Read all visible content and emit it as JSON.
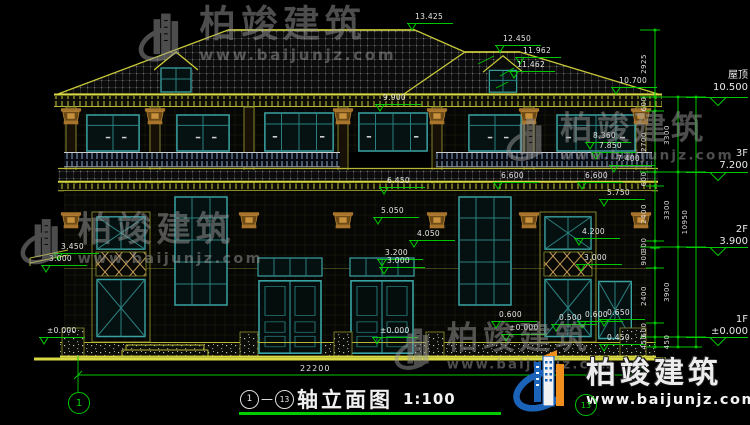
{
  "title_block": {
    "axis_start": "1",
    "axis_end": "13",
    "dash": "—",
    "name": "轴立面图",
    "scale": "1:100"
  },
  "axis_bubbles": {
    "left": "1",
    "right": "13"
  },
  "bottom_dimension": {
    "value": "22200"
  },
  "watermark": {
    "brand": "柏竣建筑",
    "url": "www.baijunjz.com",
    "gray_positions": [
      {
        "x": 138,
        "y": 6,
        "s": 1.02
      },
      {
        "x": 506,
        "y": 112,
        "s": 0.9
      },
      {
        "x": 20,
        "y": 212,
        "s": 0.96
      },
      {
        "x": 394,
        "y": 322,
        "s": 0.88
      }
    ]
  },
  "floor_labels": [
    {
      "name": "屋顶",
      "elev": "10.500",
      "top": 70,
      "sym": 95
    },
    {
      "name": "3F",
      "elev": "7.200",
      "top": 148,
      "sym": 170
    },
    {
      "name": "2F",
      "elev": "3.900",
      "top": 224,
      "sym": 245
    },
    {
      "name": "1F",
      "elev": "±0.000",
      "top": 314,
      "sym": 335
    }
  ],
  "dim_chains": [
    {
      "x": 655,
      "segs": [
        {
          "label": "2925",
          "y1": 30,
          "y2": 97
        },
        {
          "label": "600",
          "y1": 97,
          "y2": 111
        },
        {
          "label": "2700",
          "y1": 111,
          "y2": 172
        },
        {
          "label": "600",
          "y1": 172,
          "y2": 186
        },
        {
          "label": "2400",
          "y1": 186,
          "y2": 241
        },
        {
          "label": "300",
          "y1": 241,
          "y2": 248
        },
        {
          "label": "900",
          "y1": 248,
          "y2": 268
        },
        {
          "label": "2400",
          "y1": 268,
          "y2": 323
        },
        {
          "label": "600",
          "y1": 323,
          "y2": 337
        },
        {
          "label": "450",
          "y1": 337,
          "y2": 347
        }
      ]
    },
    {
      "x": 678,
      "segs": [
        {
          "label": "3300",
          "y1": 97,
          "y2": 172
        },
        {
          "label": "3300",
          "y1": 172,
          "y2": 247
        },
        {
          "label": "3900",
          "y1": 247,
          "y2": 337
        },
        {
          "label": "450",
          "y1": 337,
          "y2": 347
        }
      ]
    },
    {
      "x": 696,
      "segs": [
        {
          "label": "10950",
          "y1": 97,
          "y2": 347
        }
      ]
    }
  ],
  "level_markers": [
    {
      "v": "13.425",
      "x": 408,
      "y": 30
    },
    {
      "v": "12.450",
      "x": 496,
      "y": 52
    },
    {
      "v": "11.962",
      "x": 516,
      "y": 64
    },
    {
      "v": "11.462",
      "x": 510,
      "y": 78
    },
    {
      "v": "10.700",
      "x": 612,
      "y": 94
    },
    {
      "v": "9.900",
      "x": 376,
      "y": 111
    },
    {
      "v": "8.360",
      "x": 586,
      "y": 149
    },
    {
      "v": "7.850",
      "x": 592,
      "y": 159
    },
    {
      "v": "7.400",
      "x": 610,
      "y": 172
    },
    {
      "v": "6.600",
      "x": 494,
      "y": 189
    },
    {
      "v": "6.600",
      "x": 578,
      "y": 189
    },
    {
      "v": "6.450",
      "x": 380,
      "y": 194
    },
    {
      "v": "5.750",
      "x": 600,
      "y": 206
    },
    {
      "v": "5.050",
      "x": 374,
      "y": 224
    },
    {
      "v": "4.200",
      "x": 575,
      "y": 245
    },
    {
      "v": "4.050",
      "x": 410,
      "y": 247
    },
    {
      "v": "3.450",
      "x": 54,
      "y": 260
    },
    {
      "v": "3.200",
      "x": 378,
      "y": 266
    },
    {
      "v": "3.000",
      "x": 42,
      "y": 272
    },
    {
      "v": "3.000",
      "x": 380,
      "y": 274
    },
    {
      "v": "3.000",
      "x": 577,
      "y": 271
    },
    {
      "v": "0.600",
      "x": 492,
      "y": 328
    },
    {
      "v": "0.500",
      "x": 552,
      "y": 331
    },
    {
      "v": "0.600",
      "x": 578,
      "y": 328
    },
    {
      "v": "0.650",
      "x": 600,
      "y": 326
    },
    {
      "v": "0.450",
      "x": 600,
      "y": 351
    },
    {
      "v": "±0.000",
      "x": 40,
      "y": 344
    },
    {
      "v": "±0.000",
      "x": 373,
      "y": 344
    },
    {
      "v": "±0.000",
      "x": 502,
      "y": 341
    }
  ],
  "colors": {
    "dimension_green": "#00c800",
    "trim_yellow": "#b7b733",
    "window_teal": "#3aa3a3",
    "capital_brown": "#a8742c",
    "watermark_gray": "#9a9a9a",
    "logo_blue": "#1b63b8",
    "logo_orange": "#ef8d1d",
    "underline_green": "#00cc00"
  }
}
